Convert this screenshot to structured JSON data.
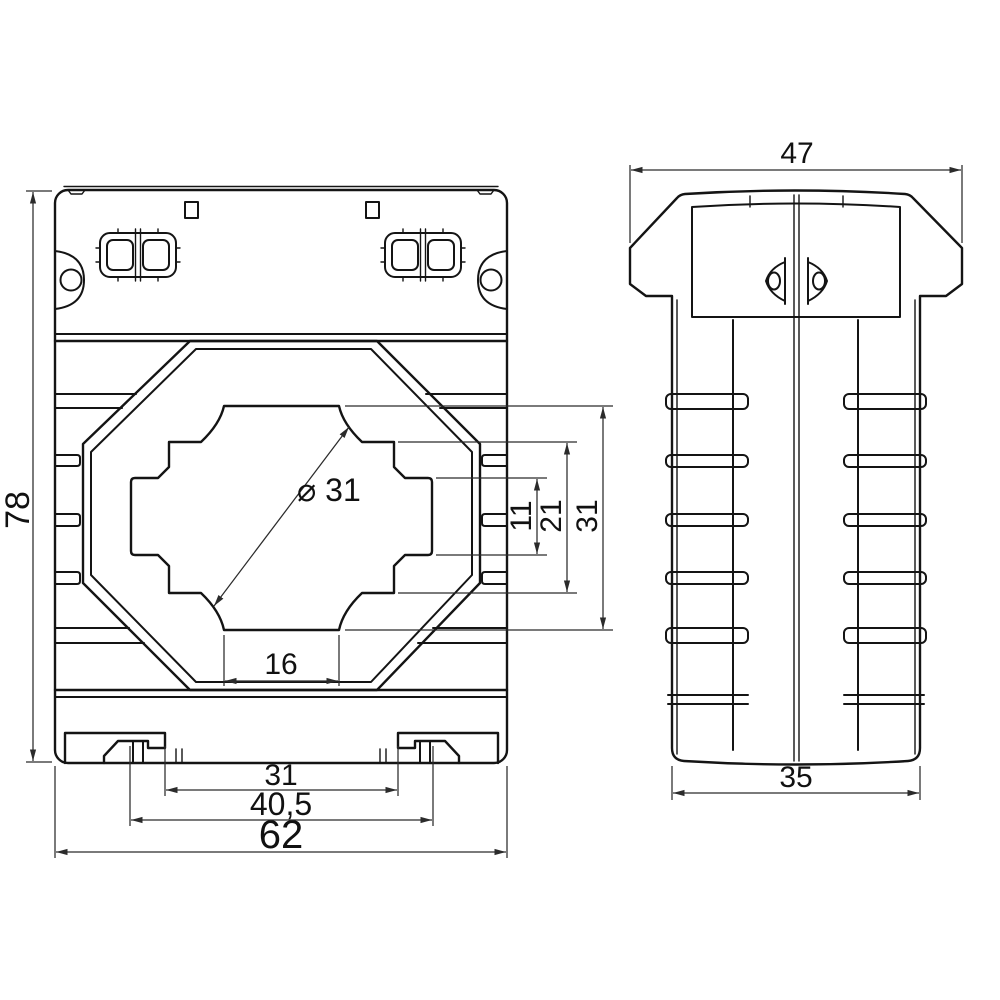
{
  "canvas": {
    "background": "#ffffff",
    "line_color": "#141414",
    "dim_color": "#2b2b2b"
  },
  "front_view": {
    "dimensions": {
      "overall_height": "78",
      "overall_width": "62",
      "din_clip_outer_span": "40,5",
      "din_clip_inner_span": "31",
      "window_bottom_width": "16",
      "aperture_diameter": "⌀ 31",
      "aperture_band_height": "11",
      "aperture_mid_height": "21",
      "aperture_total_height": "31"
    }
  },
  "side_view": {
    "dimensions": {
      "top_width": "47",
      "body_width": "35"
    }
  }
}
